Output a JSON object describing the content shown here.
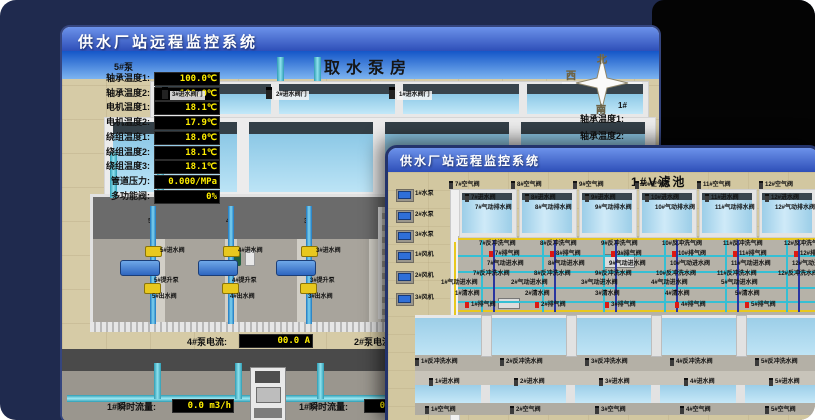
{
  "app": {
    "title": "供水厂站远程监控系统"
  },
  "colors": {
    "value_text": "#ffee00",
    "alarm_red": "#dd1812",
    "titlebar_blue": "#3f62c8",
    "pipe_cyan": "#45c4d8",
    "valve_yellow": "#e8c81e"
  },
  "back_window": {
    "title": "供水厂站远程监控系统",
    "scene_title": "取水泵房",
    "pump_panel": {
      "header": "5#泵",
      "rows": [
        {
          "label": "轴承温度1:",
          "value": "100.0℃"
        },
        {
          "label": "轴承温度2:",
          "value": "100.0℃"
        },
        {
          "label": "电机温度1:",
          "value": "18.1℃"
        },
        {
          "label": "电机温度2:",
          "value": "17.9℃"
        },
        {
          "label": "绕组温度1:",
          "value": "18.0℃"
        },
        {
          "label": "绕组温度2:",
          "value": "18.1℃"
        },
        {
          "label": "绕组温度3:",
          "value": "18.1℃"
        },
        {
          "label": "管道压力:",
          "value": "0.000/MPa"
        },
        {
          "label": "多功能阀:",
          "value": "0%"
        }
      ]
    },
    "intake_valves": [
      "3#进水阀门",
      "2#进水阀门",
      "1#进水阀门"
    ],
    "compass": {
      "north": "北",
      "west": "西",
      "south": "南"
    },
    "right_panel": {
      "header": "1#",
      "rows": [
        "轴承温度1:",
        "轴承温度2:"
      ]
    },
    "pump_hall": {
      "wall_labels": [
        "5#",
        "4#",
        "3#"
      ],
      "pumps": [
        {
          "inlet": "5#进水阀",
          "pump": "5#提升泵",
          "outlet": "5#出水阀"
        },
        {
          "inlet": "4#进水阀",
          "pump": "4#提升泵",
          "outlet": "4#出水阀"
        },
        {
          "inlet": "3#进水阀",
          "pump": "3#提升泵",
          "outlet": "3#出水阀"
        }
      ]
    },
    "current_readouts": [
      {
        "label": "4#泵电流:",
        "value": "00.0 A"
      },
      {
        "label": "2#泵电流",
        "value": ""
      }
    ],
    "flow_readouts": [
      {
        "label": "1#瞬时流量:",
        "value": "0.0 m3/h"
      },
      {
        "label": "1#瞬时流量:",
        "value": "0.0 m3/h"
      }
    ]
  },
  "front_window": {
    "title": "供水厂站远程监控系统",
    "scene_title": "1#V滤池",
    "left_devices": [
      "1#水泵",
      "2#水泵",
      "3#水泵",
      "1#风机",
      "2#风机",
      "3#风机"
    ],
    "top_cells": {
      "numbers": [
        7,
        8,
        9,
        10,
        11,
        12
      ],
      "air_valve": "空气阀",
      "inlet_valve": "进水阀",
      "pneumatic_drain_valve": "气动排水阀",
      "backwash_air_valve": "反冲洗气阀",
      "exhaust_valve": "排气阀",
      "pneumatic_inlet_valve": "气动进水阀",
      "backwash_water_valve": "反冲洗水阀"
    },
    "bottom_cells": {
      "numbers": [
        1,
        2,
        3,
        4,
        5
      ],
      "pneumatic_inlet_valve": "气动进水阀",
      "clean_water_valve": "清水阀",
      "exhaust_valve": "排气阀",
      "backwash_water_valve": "反冲洗水阀",
      "inlet_valve": "进水阀",
      "air_valve": "空气阀"
    }
  }
}
